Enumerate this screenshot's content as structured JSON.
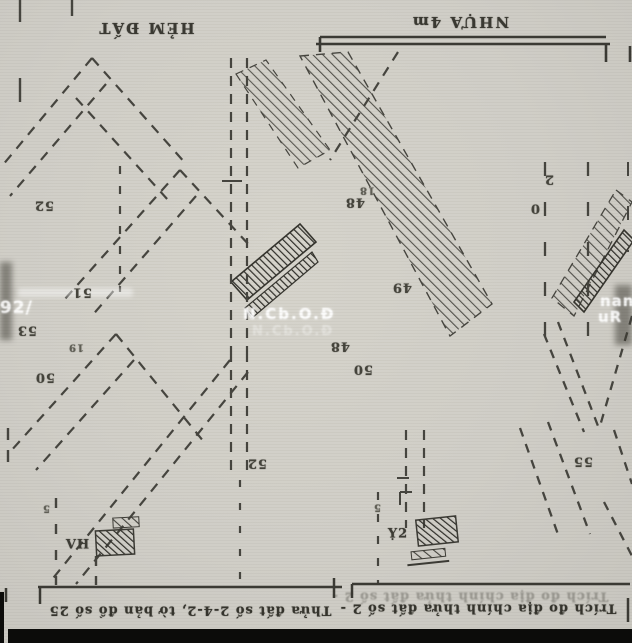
{
  "map": {
    "titles": {
      "top_left": "HẺM ĐẤT",
      "top_right": "NHỰA 4m"
    },
    "parcel_labels": [
      {
        "text": "52"
      },
      {
        "text": "51"
      },
      {
        "text": "53"
      },
      {
        "text": "19"
      },
      {
        "text": "50"
      },
      {
        "text": "48"
      },
      {
        "text": "18"
      },
      {
        "text": "49"
      },
      {
        "text": "48"
      },
      {
        "text": "50"
      },
      {
        "text": "52"
      },
      {
        "text": "55"
      },
      {
        "text": "2"
      },
      {
        "text": "0"
      },
      {
        "text": "5"
      },
      {
        "text": "5"
      }
    ],
    "legend": {
      "left_label": "VH",
      "right_label": "Ỵ2"
    },
    "watermarks": {
      "center": "N.Cb.O.Đ",
      "left": "2h92/",
      "right_top": "nan",
      "right_bottom": "uR"
    },
    "notes": {
      "bottom_left": "Thửa đất số 2-4-2, tờ bản đồ số 25",
      "bottom_right": "Trích đo địa chính thửa đất số 2 -"
    },
    "colors": {
      "paper": "#d0cec7",
      "ink": "#46453f",
      "dark_ink": "#2f2e29",
      "watermark": "#ffffff"
    }
  }
}
